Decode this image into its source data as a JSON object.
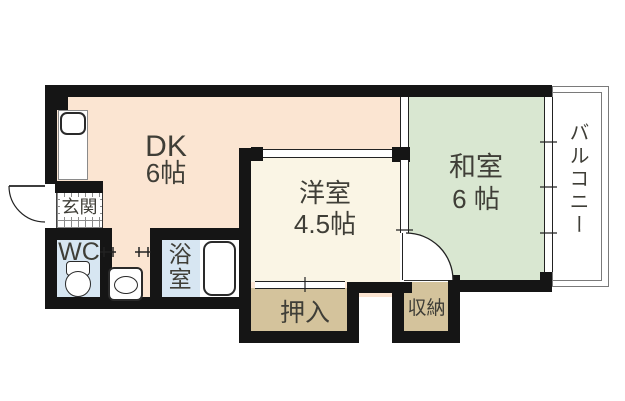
{
  "floorplan": {
    "rooms": {
      "dk": {
        "name": "DK",
        "size": "6帖"
      },
      "western_room": {
        "name": "洋室",
        "size": "4.5帖"
      },
      "japanese_room": {
        "name": "和室",
        "size": "6 帖"
      },
      "balcony": {
        "name": "バルコニー"
      },
      "entrance": {
        "name": "玄関"
      },
      "toilet": {
        "name": "WC"
      },
      "bathroom": {
        "name": "浴室"
      },
      "closet": {
        "name": "押入"
      },
      "storage": {
        "name": "収納"
      }
    },
    "colors": {
      "dk-floor": "#fbe5d2",
      "japanese-floor": "#d9e7d1",
      "western-floor": "#faf5e5",
      "closet-floor": "#d4c39c",
      "wet-floor": "#d7e6f2",
      "wall": "#151515",
      "label": "#3f3e37"
    }
  }
}
